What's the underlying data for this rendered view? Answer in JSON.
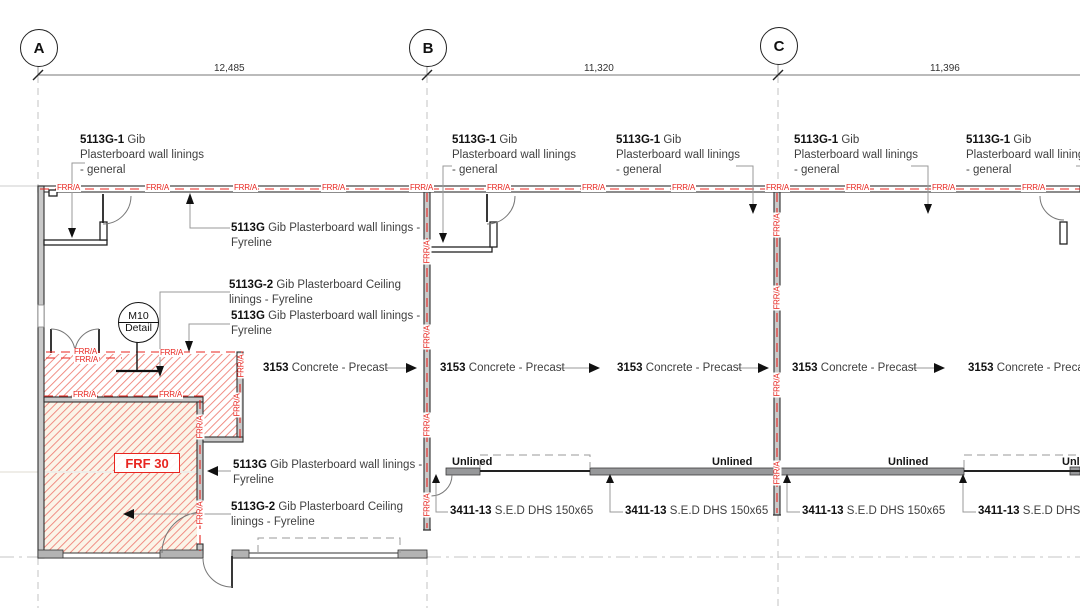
{
  "grid_bubbles": [
    "A",
    "B",
    "C"
  ],
  "dimensions": [
    "12,485",
    "11,320",
    "11,396"
  ],
  "labels": {
    "general": {
      "code": "5113G-1",
      "l1": "Gib",
      "l2": "Plasterboard wall linings",
      "l3": "- general"
    },
    "fyreline": {
      "code": "5113G",
      "l1": "Gib Plasterboard wall linings -",
      "l2": "Fyreline"
    },
    "ceiling": {
      "code": "5113G-2",
      "l1": "Gib Plasterboard Ceiling",
      "l2": "linings - Fyreline"
    },
    "precast": {
      "code": "3153",
      "rest": "Concrete - Precast"
    },
    "dhs": {
      "code": "3411-13",
      "rest": "S.E.D DHS 150x65"
    },
    "unlined": "Unlined",
    "frr": "FRR/A",
    "frf": "FRF 30",
    "detail": {
      "top": "M10",
      "bottom": "Detail"
    }
  },
  "colors": {
    "fire_red": "#e8251f",
    "hatch_red": "#ef8279",
    "wall_gray": "#c9c9c9",
    "girt_gray": "#97989a",
    "line_dark": "#2f2f2f"
  }
}
